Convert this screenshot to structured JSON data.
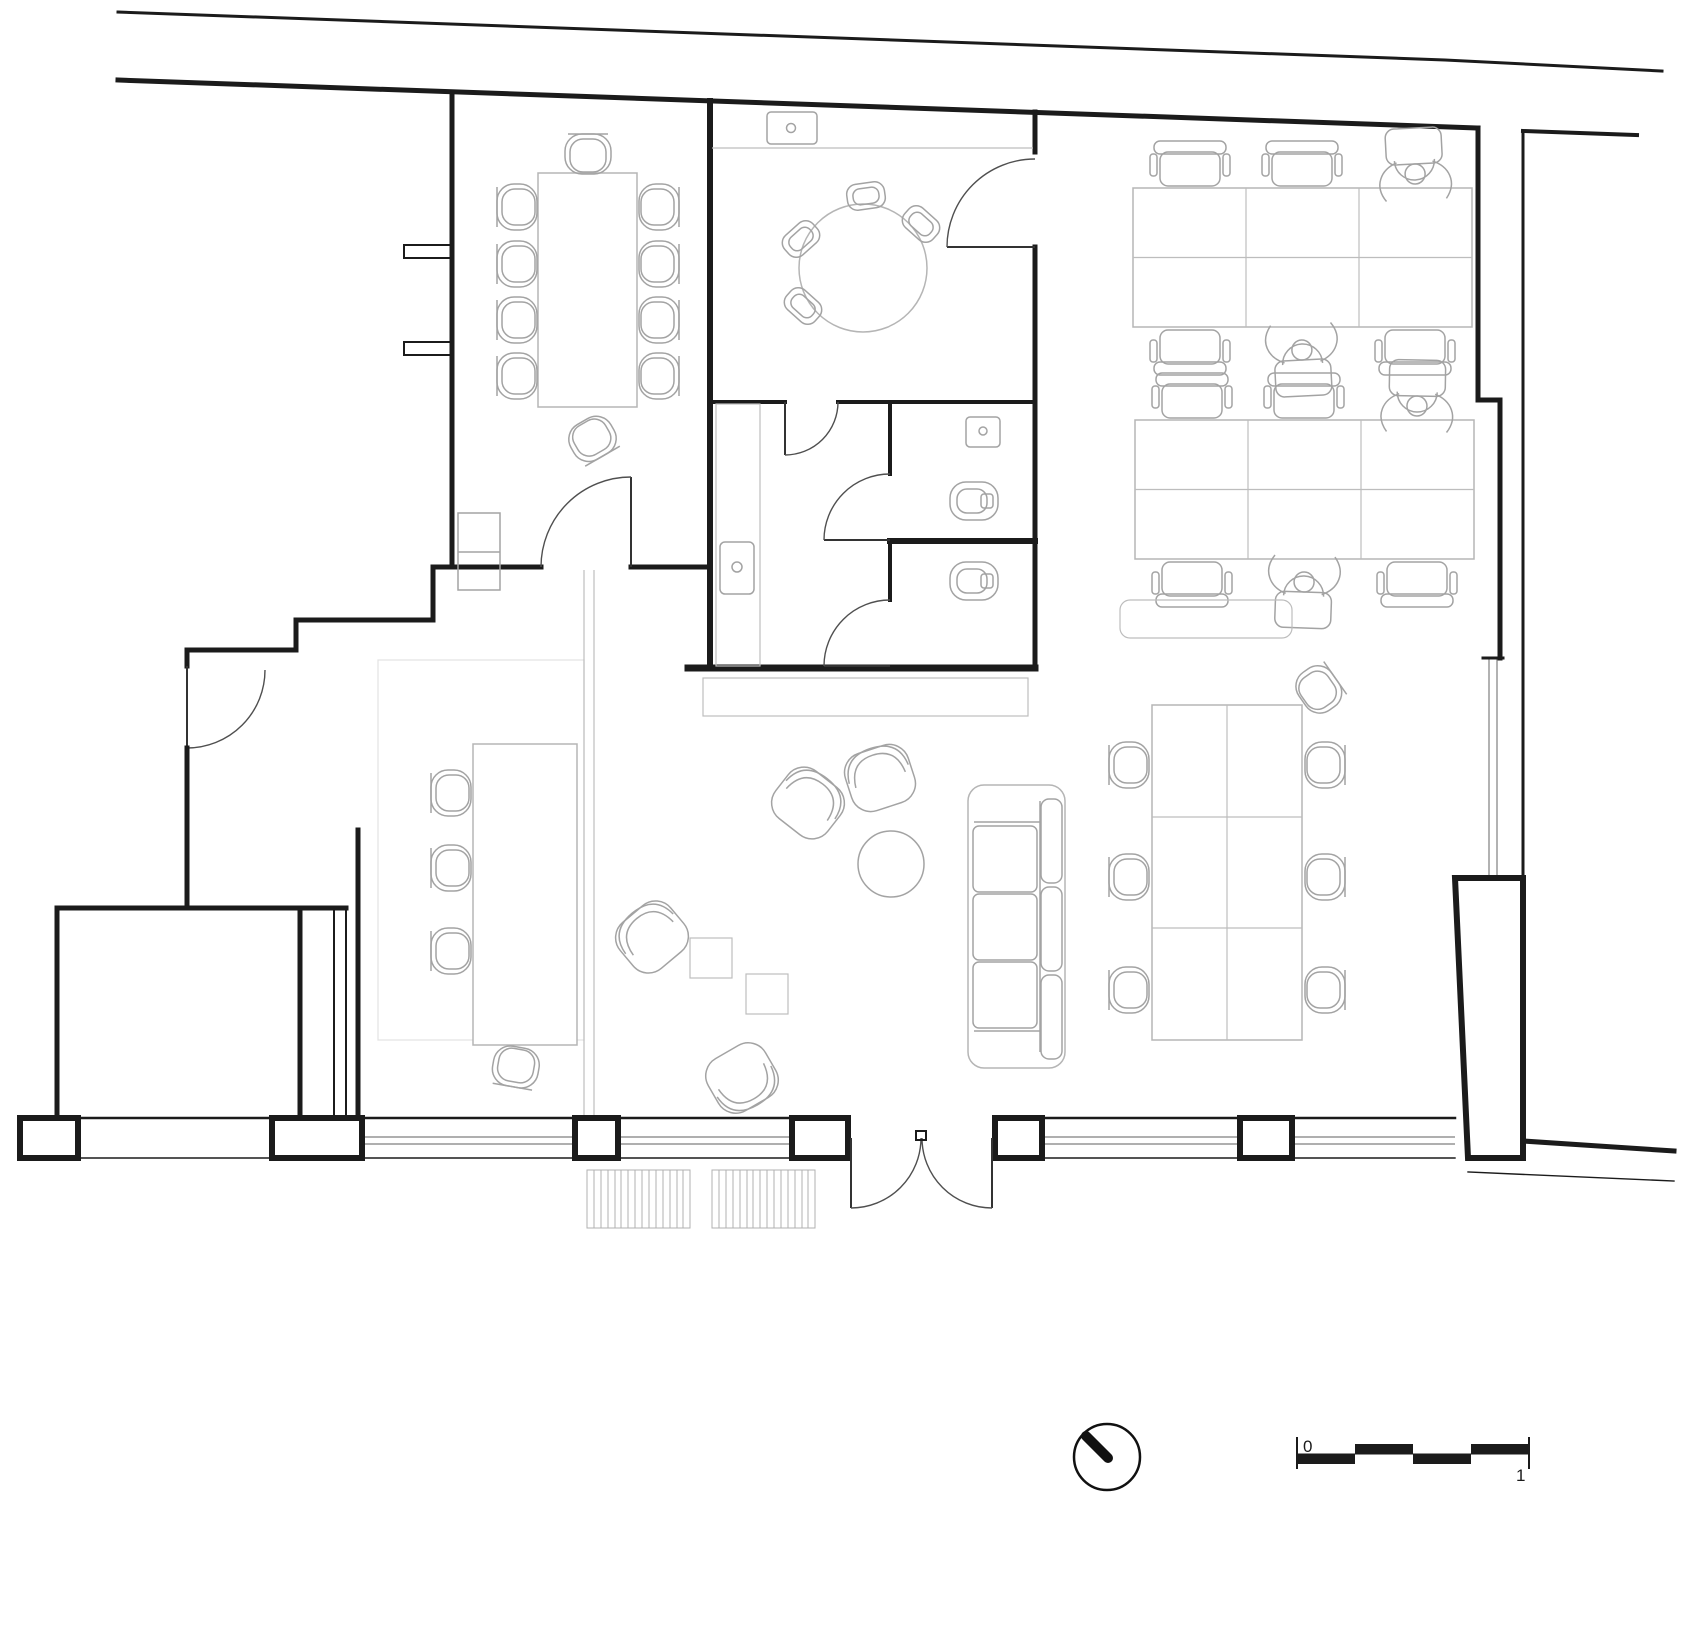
{
  "page": {
    "kind": "architectural floor plan, office fit-out, plan view",
    "background": "#ffffff"
  },
  "scale_bar": {
    "zero_label": "0",
    "one_label": "1"
  },
  "colors": {
    "walls": "#1b1b1b",
    "doors": "#4f4f4f",
    "furniture": "#a3a3a3",
    "furniture_light": "#bdbdbd",
    "glazing": "#7f7f7f",
    "floor_lines": "#e2e2e2",
    "text": "#1b1b1b"
  },
  "icons": {
    "north_arrow": "north-arrow",
    "graphic_scale": "scale-bar"
  },
  "inventory": {
    "meeting_room_chairs": 10,
    "meeting_table": 1,
    "kitchen_round_table": 1,
    "kitchen_stools": 4,
    "wc_stalls": 2,
    "wc_sinks": 3,
    "office_desk_clusters": 2,
    "office_desks": 12,
    "seated_people": 4,
    "lounge_armchairs": 4,
    "sofa": 1,
    "side_tables": 2,
    "long_tables": 2,
    "double_entry_door": 1,
    "window_piers": 6,
    "floor_grates": 2
  }
}
